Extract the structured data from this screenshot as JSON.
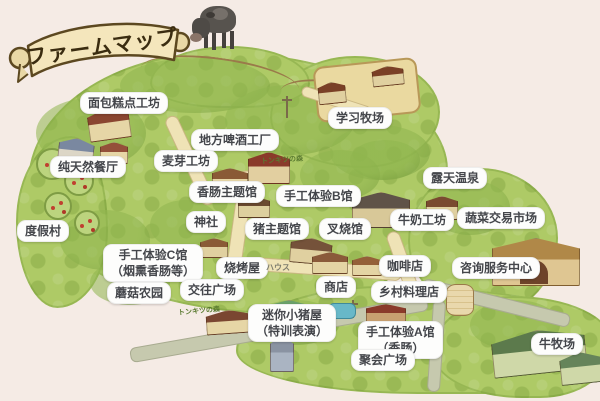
{
  "banner": {
    "title": "ファームマップ"
  },
  "labels": {
    "bakery": "面包糕点工坊",
    "brewery": "地方啤酒工厂",
    "learning_ranch": "学习牧场",
    "malt_workshop": "麦芽工坊",
    "natural_restaurant": "纯天然餐厅",
    "open_air_onsen": "露天温泉",
    "sausage_theme_hall": "香肠主题馆",
    "handcraft_b": "手工体验B馆",
    "shrine": "神社",
    "pig_theme_hall": "猪主题馆",
    "char_siu_hall": "叉烧馆",
    "milk_workshop": "牛奶工坊",
    "vegetable_market": "蔬菜交易市场",
    "resort_village": "度假村",
    "handcraft_c": {
      "line1": "手工体验C馆",
      "line2": "（烟熏香肠等）"
    },
    "bbq_house": "烧烤屋",
    "coffee_shop": "咖啡店",
    "info_center": "咨询服务中心",
    "mushroom_farm": "蘑菇农园",
    "exchange_plaza": "交往广场",
    "shop": "商店",
    "country_restaurant": "乡村料理店",
    "mini_pig": {
      "line1": "迷你小猪屋",
      "line2": "（特训表演）"
    },
    "handcraft_a": {
      "line1": "手工体验A馆",
      "line2": "（香肠）"
    },
    "party_plaza": "聚会广场",
    "cattle_ranch": "牛牧场"
  },
  "decor": {
    "house_katakana": "ハウス",
    "forest_note_top": "トンキツの森",
    "forest_note_bottom": "トンキツの森"
  },
  "colors": {
    "background": "#f5ebe5",
    "terrain_green": "#aeca66",
    "path_cream": "#efe3b6",
    "road_gray": "#c6c9ae",
    "label_bg": "#fdfdfc",
    "label_text": "#44464b",
    "banner_fill": "#f4e6bc",
    "banner_stroke": "#5c4820"
  }
}
